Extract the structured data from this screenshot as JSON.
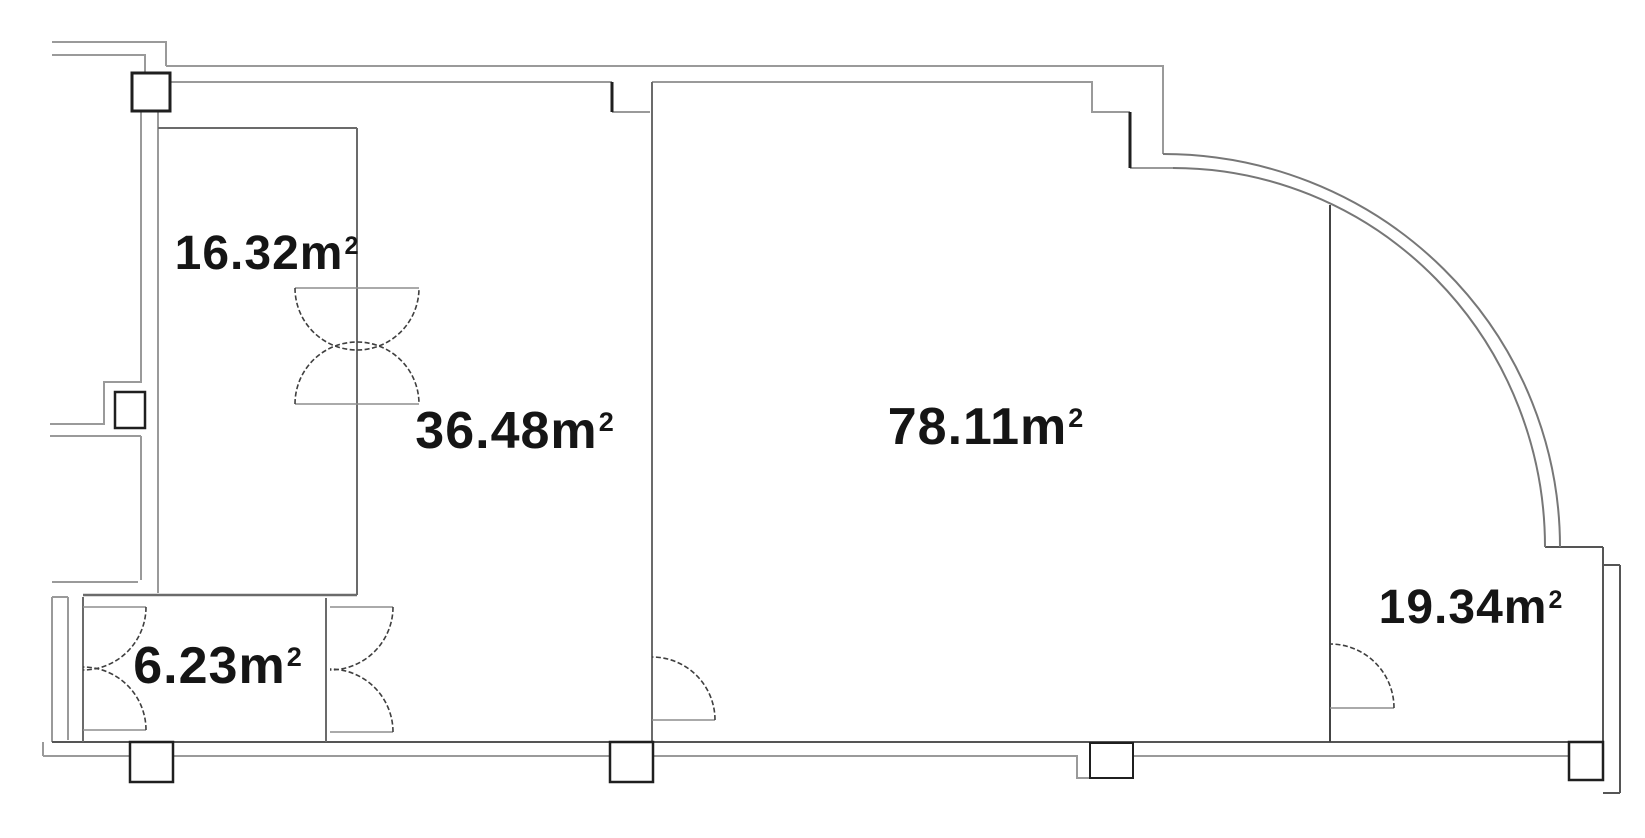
{
  "colors": {
    "background": "#ffffff",
    "wall_light": "#9a9a9a",
    "wall_mid": "#555555",
    "wall_dark": "#1f1f1f",
    "door_arc": "#3f3f3f",
    "label_text": "#151515"
  },
  "floorplan": {
    "kind": "architectural floor plan",
    "rooms": [
      {
        "name": "upper-left-room",
        "label": "16.32m",
        "sup": "2",
        "area_m2": 16.32
      },
      {
        "name": "middle-room",
        "label": "36.48m",
        "sup": "2",
        "area_m2": 36.48
      },
      {
        "name": "large-room",
        "label": "78.11m",
        "sup": "2",
        "area_m2": 78.11
      },
      {
        "name": "small-entry-room",
        "label": "6.23m",
        "sup": "2",
        "area_m2": 6.23
      },
      {
        "name": "right-room",
        "label": "19.34m",
        "sup": "2",
        "area_m2": 19.34
      }
    ]
  }
}
